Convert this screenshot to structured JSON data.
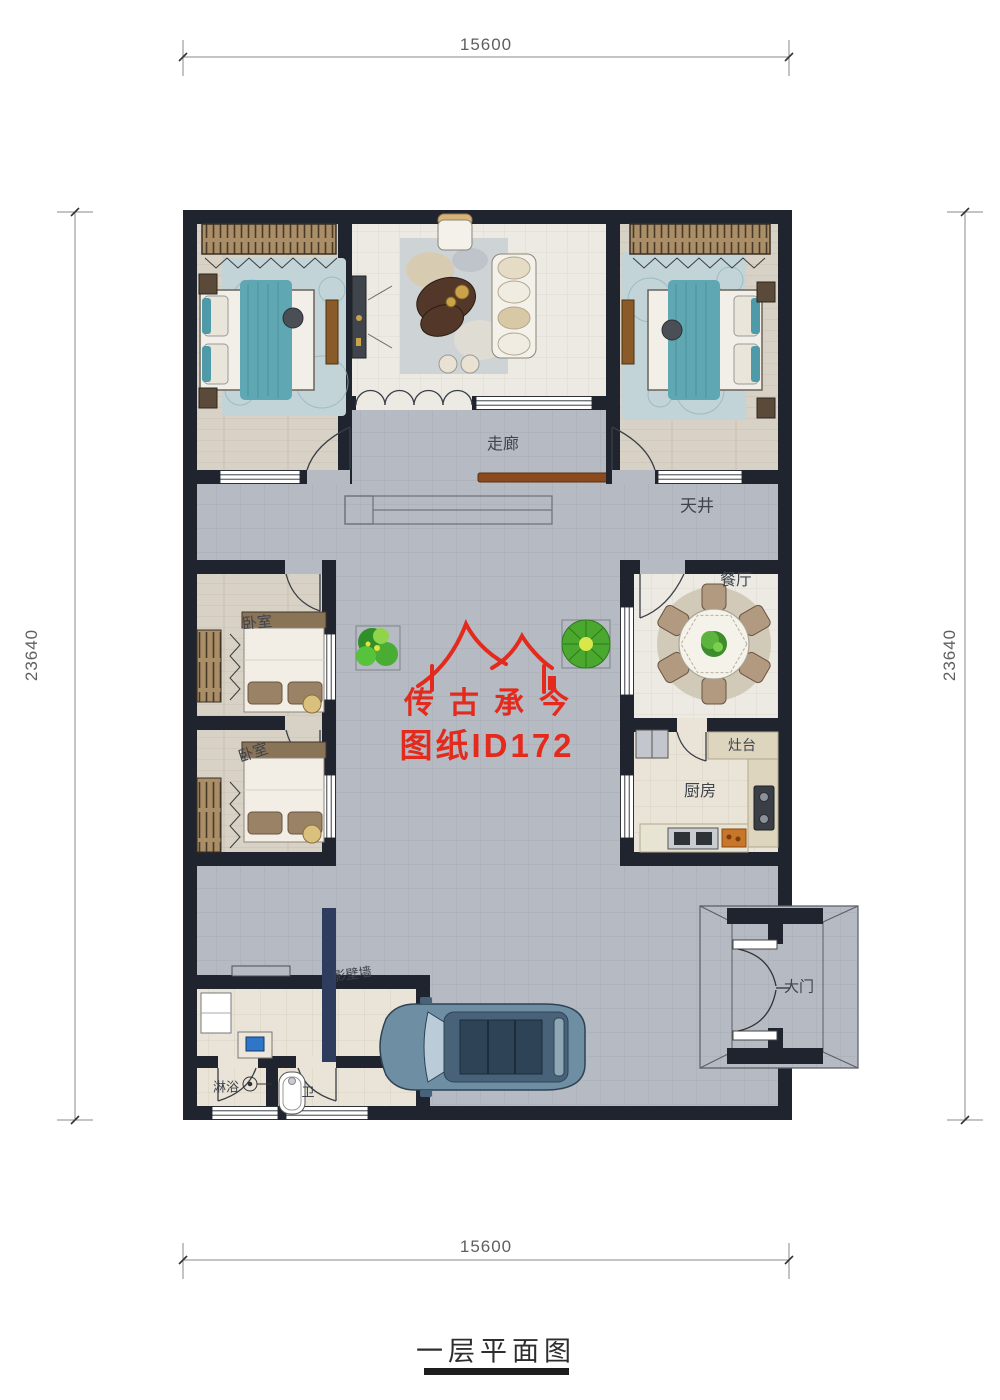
{
  "page": {
    "caption": "一层平面图"
  },
  "watermark": {
    "brand": "传古承今",
    "sheet_id": "图纸ID172",
    "color": "#e32a1d"
  },
  "dimensions": {
    "top": "15600",
    "bottom": "15600",
    "left": "23640",
    "right": "23640"
  },
  "rooms": {
    "corridor": "走廊",
    "courtyard": "天井",
    "bedroom_mid_1": "卧室",
    "bedroom_mid_2": "卧室",
    "dining": "餐厅",
    "stove": "灶台",
    "kitchen": "厨房",
    "screen_wall": "影壁墙",
    "gate": "大门",
    "shower": "淋浴",
    "bath": "卫"
  },
  "colors": {
    "wall": "#20242e",
    "courtyard": "#b6bac2",
    "room_tile": "#eceae3",
    "wood_floor": "#d8d2c6",
    "accent_teal": "#5fa7b2",
    "screen_wall_navy": "#2e3c5e",
    "watermark_red": "#e32a1d"
  }
}
